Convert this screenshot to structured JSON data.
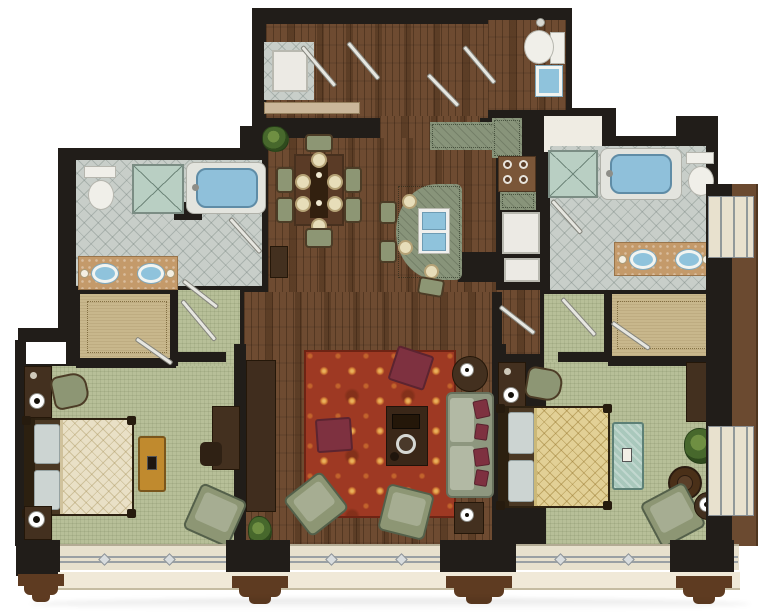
{
  "meta": {
    "type": "floor-plan",
    "view": "top-down illustrated architectural rendering",
    "description": "Two-bedroom, two-and-a-half-bath suite with central entry foyer, dining area, kitchen with curved island, living room on hardwood, mirrored bedroom wings with walk-in closets, and a window wall with corbels along the bottom facade"
  },
  "colors": {
    "wall": "#211d19",
    "wood": "#6e4b31",
    "carpet": "#b7bf98",
    "tile": "#c8cec9",
    "tan": "#c8b78c",
    "linen": "#efece3",
    "cream": "#e8e1ce",
    "creamLight": "#f0e9d8",
    "corbel": "#5e3b21",
    "band": "#6b4a30",
    "rug": "#9e3923",
    "rugFlower": "#d98a3a",
    "maroon": "#7e3140",
    "sofa": "#8e977f",
    "cushion": "#b2b9a4",
    "chairGreen": "#8d9674",
    "counter": "#88947a",
    "sinkBlue": "#8fc3dc",
    "tubBlue": "#8fc0da",
    "vanity": "#c49a6a",
    "furnDark": "#43301f",
    "duvetCream": "#e9e0c6",
    "duvetGold": "#e2d096",
    "pillow": "#ccd4d2",
    "benchOrange": "#c08a2e",
    "benchTeal": "#a9c8bc",
    "plant": "#4e6b35",
    "glass": "#b9cfc3",
    "gray": "#9aa0a4"
  },
  "rooms": [
    {
      "name": "entry-foyer",
      "floor": "hardwood",
      "features": [
        "double-entry-doors",
        "laundry-closet-with-machine",
        "console-shelf"
      ]
    },
    {
      "name": "powder-room",
      "floor": "hardwood",
      "fixtures": [
        "toilet",
        "blue-basin-sink"
      ]
    },
    {
      "name": "dining-area",
      "floor": "hardwood",
      "furniture": [
        "rectangular-table",
        "six-chairs",
        "six-place-settings",
        "potted-plant",
        "side-cabinet"
      ]
    },
    {
      "name": "kitchen",
      "floor": "hardwood",
      "features": [
        "l-shaped-green-counter",
        "four-burner-cooktop",
        "refrigerator",
        "curved-island-with-double-sink",
        "three-bar-stools"
      ]
    },
    {
      "name": "living-room",
      "floor": "hardwood",
      "furniture": [
        "red-patterned-area-rug",
        "sofa-with-maroon-pillows",
        "two-green-armchairs",
        "coffee-table-with-tray",
        "two-maroon-ottomans",
        "media-console",
        "round-lamp-table",
        "square-lamp-table",
        "potted-plant"
      ]
    },
    {
      "name": "left-bedroom",
      "floor": "carpet",
      "furniture": [
        "king-bed-cream-duvet",
        "two-nightstands-with-lamps",
        "green-armchair",
        "orange-foot-bench",
        "desk-with-chair",
        "green-lounge-chair"
      ]
    },
    {
      "name": "right-bedroom",
      "floor": "carpet",
      "furniture": [
        "king-bed-gold-duvet",
        "two-nightstands-with-lamps",
        "green-armchair",
        "teal-foot-bench",
        "desk",
        "round-ottoman",
        "lounge-chair",
        "round-lamp-table",
        "potted-plant"
      ]
    },
    {
      "name": "left-bathroom",
      "floor": "tile",
      "fixtures": [
        "glass-shower",
        "soaking-tub",
        "toilet",
        "double-vanity-two-sinks"
      ]
    },
    {
      "name": "right-bathroom",
      "floor": "tile",
      "fixtures": [
        "glass-shower",
        "soaking-tub",
        "toilet",
        "double-vanity-two-sinks"
      ]
    },
    {
      "name": "left-walk-in-closet",
      "floor": "tan-carpet"
    },
    {
      "name": "right-walk-in-closet",
      "floor": "tan-carpet"
    },
    {
      "name": "window-facade",
      "features": [
        "four-black-piers",
        "cream-window-bands",
        "rail-with-ornaments",
        "brown-corbels",
        "right-side-window-bays"
      ]
    }
  ]
}
